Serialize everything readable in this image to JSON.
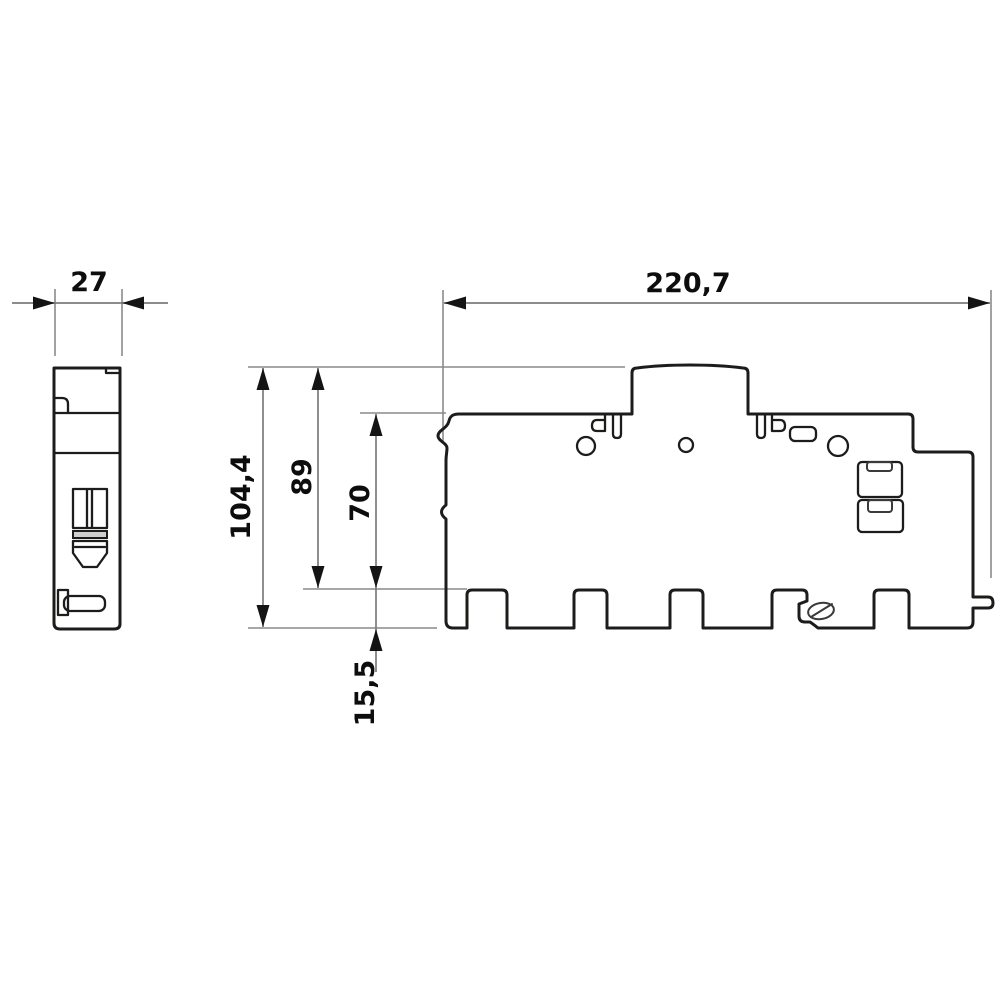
{
  "drawing": {
    "kind": "technical-dimension-drawing",
    "views": "side view (left) and front view (right) of a DIN-rail busbar housing",
    "background_color": "#ffffff",
    "outline_color": "#1c1c1b",
    "dimension_line_color": "#7b7b7b",
    "text_color": "#0d0d0d",
    "side_view": {
      "width": "27"
    },
    "front_view": {
      "overall_width": "220,7",
      "overall_height": "104,4",
      "upper_height": "89",
      "body_height": "70",
      "foot_height": "15,5"
    }
  }
}
